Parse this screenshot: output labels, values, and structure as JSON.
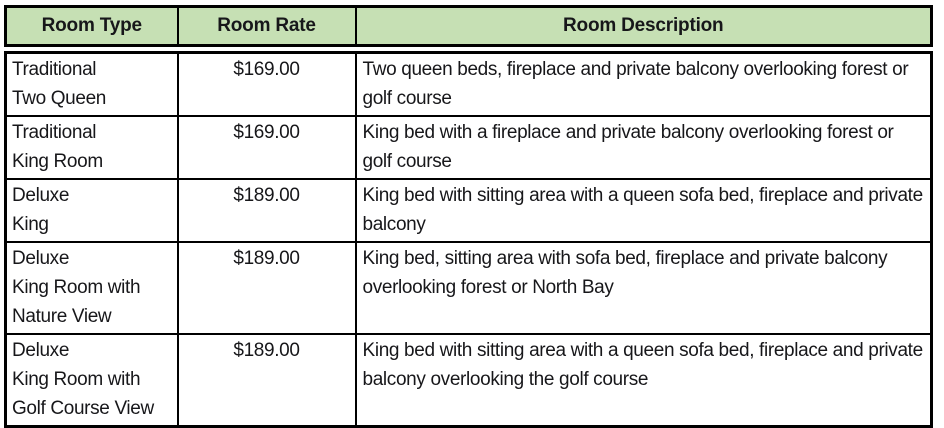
{
  "colors": {
    "header_bg": "#c6e0b4",
    "border": "#000000",
    "text": "#17171a"
  },
  "table": {
    "columns": {
      "room_type": "Room Type",
      "room_rate": "Room Rate",
      "room_description": "Room Description"
    },
    "rows": [
      {
        "type_lines": [
          "Traditional",
          "Two Queen"
        ],
        "rate": "$169.00",
        "description": "Two queen beds, fireplace and private balcony overlooking forest or golf course"
      },
      {
        "type_lines": [
          "Traditional",
          "King Room"
        ],
        "rate": "$169.00",
        "description": "King bed with a fireplace and private balcony overlooking forest or golf course"
      },
      {
        "type_lines": [
          "Deluxe",
          "King"
        ],
        "rate": "$189.00",
        "description": "King bed with sitting area with a queen sofa bed, fireplace and private balcony"
      },
      {
        "type_lines": [
          "Deluxe",
          "King Room with",
          "Nature View"
        ],
        "rate": "$189.00",
        "description": "King bed, sitting area with sofa bed, fireplace and private balcony overlooking forest or North Bay"
      },
      {
        "type_lines": [
          "Deluxe",
          "King Room with",
          "Golf Course View"
        ],
        "rate": "$189.00",
        "description": "King bed with sitting area with a queen sofa bed, fireplace and private balcony overlooking the golf course"
      }
    ]
  }
}
